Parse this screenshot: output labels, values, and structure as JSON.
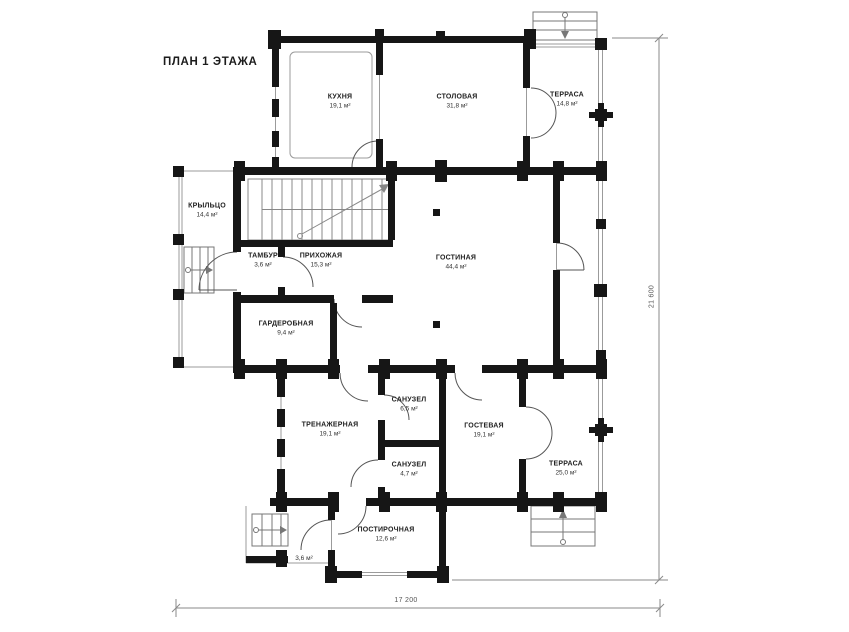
{
  "title": "ПЛАН 1 ЭТАЖА",
  "rooms": [
    {
      "id": "kitchen",
      "name": "КУХНЯ",
      "area": "19,1 м²"
    },
    {
      "id": "dining",
      "name": "СТОЛОВАЯ",
      "area": "31,8 м²"
    },
    {
      "id": "terrace-top",
      "name": "ТЕРРАСА",
      "area": "14,8 м²"
    },
    {
      "id": "porch",
      "name": "КРЫЛЬЦО",
      "area": "14,4 м²"
    },
    {
      "id": "vestibule",
      "name": "ТАМБУР",
      "area": "3,6 м²"
    },
    {
      "id": "hallway",
      "name": "ПРИХОЖАЯ",
      "area": "15,3 м²"
    },
    {
      "id": "living-room",
      "name": "ГОСТИНАЯ",
      "area": "44,4 м²"
    },
    {
      "id": "wardrobe",
      "name": "ГАРДЕРОБНАЯ",
      "area": "9,4 м²"
    },
    {
      "id": "gym",
      "name": "ТРЕНАЖЕРНАЯ",
      "area": "19,1 м²"
    },
    {
      "id": "bathroom-1",
      "name": "САНУЗЕЛ",
      "area": "6,5 м²"
    },
    {
      "id": "bathroom-2",
      "name": "САНУЗЕЛ",
      "area": "4,7 м²"
    },
    {
      "id": "guest-room",
      "name": "ГОСТЕВАЯ",
      "area": "19,1 м²"
    },
    {
      "id": "terrace-bottom",
      "name": "ТЕРРАСА",
      "area": "25,0 м²"
    },
    {
      "id": "laundry",
      "name": "ПОСТИРОЧНАЯ",
      "area": "12,6 м²"
    },
    {
      "id": "small-porch",
      "name": "",
      "area": "3,6 м²"
    }
  ],
  "dimensions": {
    "total_height_mm": "21 600",
    "total_width_mm": "17 200"
  },
  "colors": {
    "wall": "#161616",
    "thin_line": "#9b9b9b",
    "door_arc": "#555555",
    "dimension": "#8a8a8a",
    "background": "#ffffff",
    "text": "#222222"
  }
}
